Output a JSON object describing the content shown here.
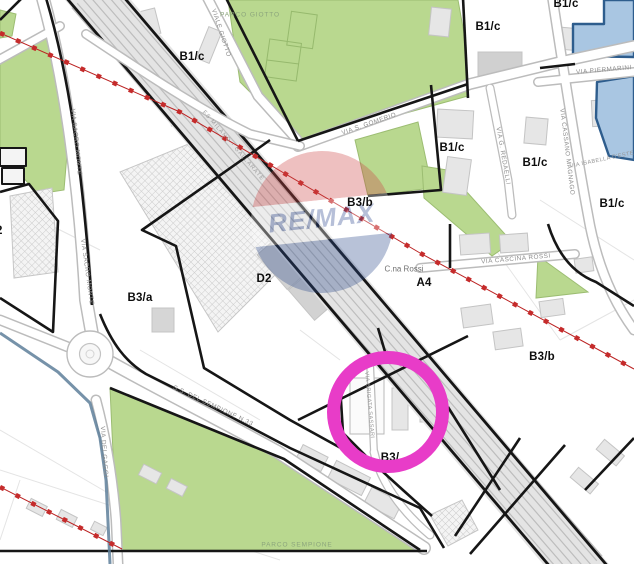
{
  "map": {
    "title": "urban zoning map detail",
    "colors": {
      "highlight_ring": "#e83cc8",
      "boundary_red_dotted": "#c22a2a",
      "park_green": "#b9d88f",
      "zone_blue_fill": "#a9c6e2",
      "zone_blue_border": "#2e5d8d",
      "railway_gray": "#e4e4e4",
      "stream_blue": "#5e7f9a",
      "parcel_black": "#161616"
    },
    "watermark": {
      "text": "RE/MAX"
    },
    "highlight": {
      "shape": "circle",
      "cx": 388,
      "cy": 412,
      "r": 54.5,
      "stroke": 13,
      "color": "#e83cc8"
    },
    "labels": [
      {
        "kind": "zone",
        "text": "B1/c",
        "x": 192,
        "y": 57
      },
      {
        "kind": "zone",
        "text": "B1/c",
        "x": 452,
        "y": 148
      },
      {
        "kind": "zone",
        "text": "B1/c",
        "x": 488,
        "y": 27
      },
      {
        "kind": "zone",
        "text": "B1/c",
        "x": 566,
        "y": 4
      },
      {
        "kind": "zone",
        "text": "B1/c",
        "x": 535,
        "y": 163
      },
      {
        "kind": "zone",
        "text": "B1/c",
        "x": 612,
        "y": 204
      },
      {
        "kind": "zone",
        "text": "B3/b",
        "x": 360,
        "y": 203
      },
      {
        "kind": "zone",
        "text": "B3/b",
        "x": 542,
        "y": 357
      },
      {
        "kind": "zone",
        "text": "B3/a",
        "x": 140,
        "y": 298
      },
      {
        "kind": "zone",
        "text": "D2",
        "x": 264,
        "y": 279
      },
      {
        "kind": "zone",
        "text": "D2",
        "x": -5,
        "y": 231
      },
      {
        "kind": "zone",
        "text": "A4",
        "x": 424,
        "y": 283
      },
      {
        "kind": "zone",
        "text": "B3/",
        "x": 390,
        "y": 458
      },
      {
        "kind": "street",
        "text": "VIALE GIOTTO",
        "x": 221,
        "y": 33,
        "rot": 72
      },
      {
        "kind": "street",
        "text": "VIA S. GOMERIO",
        "x": 369,
        "y": 124,
        "rot": -19
      },
      {
        "kind": "street",
        "text": "VIA PIERMARINI",
        "x": 604,
        "y": 70,
        "rot": -5
      },
      {
        "kind": "street",
        "text": "VIA CASSANO MAGNAGO",
        "x": 567,
        "y": 152,
        "rot": 83
      },
      {
        "kind": "street",
        "text": "VIA G. REDAELLI",
        "x": 503,
        "y": 156,
        "rot": 80
      },
      {
        "kind": "street",
        "text": "VIA CASCINA ROSSI",
        "x": 516,
        "y": 259,
        "rot": -5
      },
      {
        "kind": "street",
        "text": "VIA SACRO MONTE",
        "x": 76,
        "y": 142,
        "rot": 84
      },
      {
        "kind": "street",
        "text": "VIA SACRO MONTE",
        "x": 87,
        "y": 272,
        "rot": 82
      },
      {
        "kind": "street",
        "text": "S.S. DEL SEMPIONE N.33",
        "x": 213,
        "y": 406,
        "rot": 25
      },
      {
        "kind": "street",
        "text": "VIA DEI GAGGI",
        "x": 104,
        "y": 452,
        "rot": 86
      },
      {
        "kind": "streetsm",
        "text": "VIA ISABELLA D'ESTE",
        "x": 602,
        "y": 160,
        "rot": -12
      },
      {
        "kind": "streetsm",
        "text": "VIA BRIGATA SASSARI",
        "x": 369,
        "y": 405,
        "rot": 85
      },
      {
        "kind": "rail",
        "text": "FS MILANO - GALLARATE",
        "x": 233,
        "y": 146,
        "rot": 49
      },
      {
        "kind": "park",
        "text": "PARCO GIOTTO",
        "x": 250,
        "y": 15
      },
      {
        "kind": "park",
        "text": "PARCO SEMPIONE",
        "x": 297,
        "y": 545
      },
      {
        "kind": "place",
        "text": "C.na Rossi",
        "x": 404,
        "y": 269
      }
    ]
  }
}
